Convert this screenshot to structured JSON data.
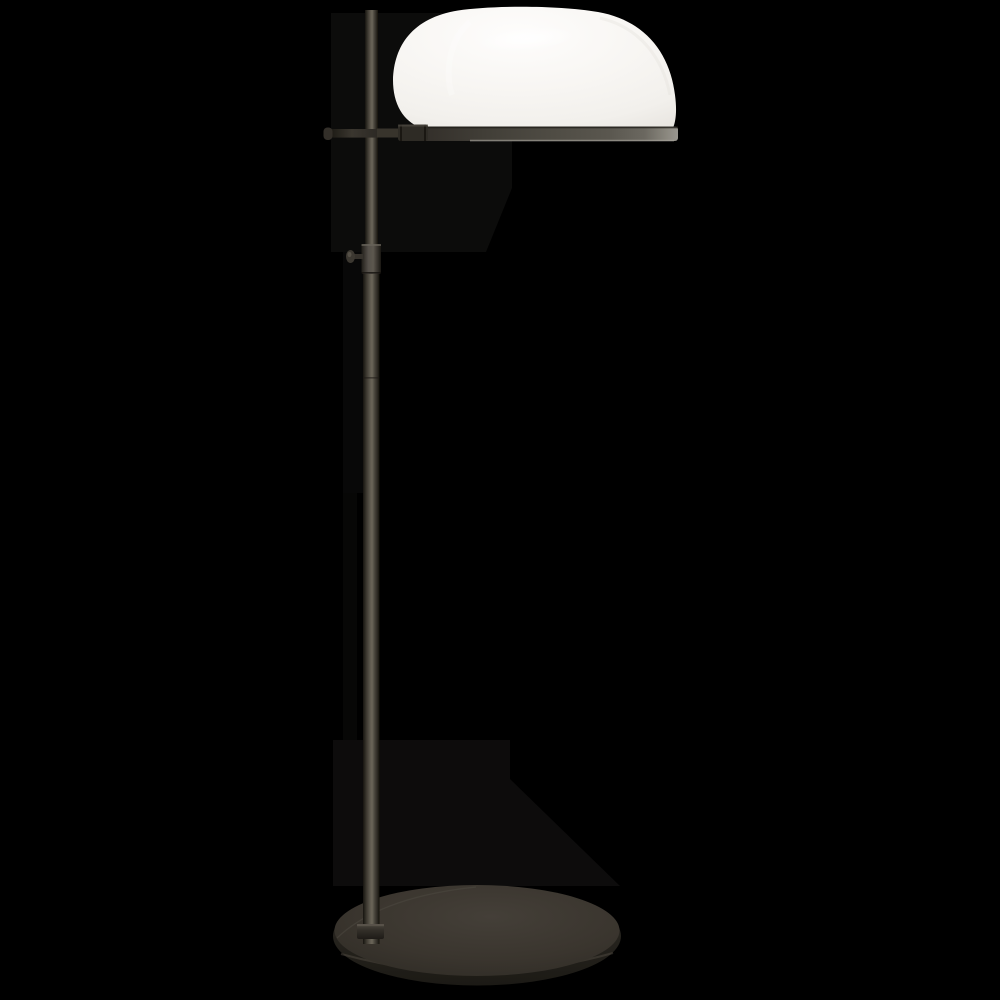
{
  "scene": {
    "type": "product-photo",
    "subject": "Adjustable bronze floor lamp with white dome shade on black background",
    "background_color": "#000000"
  },
  "lamp": {
    "shade": {
      "label": "white dome shade",
      "color_main": "#f7f5f1",
      "edge_color": "#e9e6e1"
    },
    "rim": {
      "label": "bronze shade rim band",
      "color_left": "#2a2722",
      "color_right": "#8f8c83",
      "bottom_highlight": "#a5a29a"
    },
    "arm": {
      "label": "horizontal support arm",
      "color": "#38342c"
    },
    "arm_cap": {
      "label": "arm end cap",
      "color": "#332f29"
    },
    "connector": {
      "label": "arm connector sleeve",
      "color": "#2e2b25"
    },
    "pole": {
      "label": "adjustable upright pole",
      "color_mid": "#5f5a4f",
      "color_edge": "#1a1814"
    },
    "sleeve": {
      "label": "telescoping sleeve joint",
      "color": "#45413a"
    },
    "knob": {
      "label": "height adjustment knob",
      "color": "#35312b"
    },
    "base": {
      "label": "oval weighted base",
      "color_top": "#3e3932",
      "color_edge": "#26231e",
      "edge_highlight": "#565047"
    },
    "collar": {
      "label": "pole-to-base collar",
      "color": "#302c26"
    },
    "shadow": {
      "label": "soft cast shadow",
      "color": "#d8d2c6"
    }
  }
}
